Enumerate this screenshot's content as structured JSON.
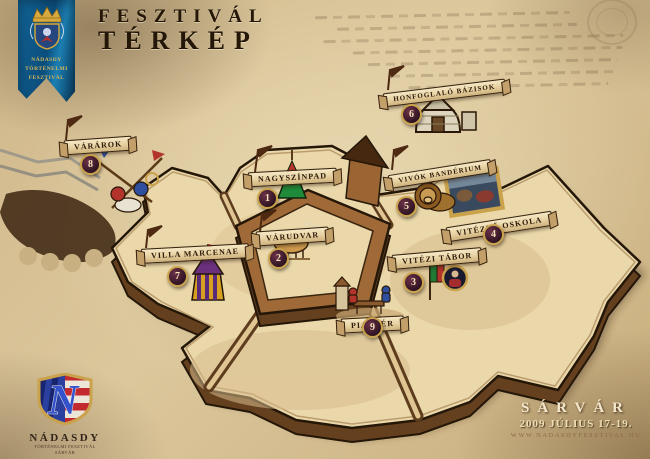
{
  "title": {
    "line1": "FESZTIVÁL",
    "line2": "TÉRKÉP"
  },
  "flag": {
    "line1": "NÁDASDY",
    "line2": "TÖRTÉNELMI",
    "line3": "FESZTIVÁL"
  },
  "locations": [
    {
      "num": "1",
      "label": "NAGYSZÍNPAD",
      "icon": "stage-tent"
    },
    {
      "num": "2",
      "label": "VÁRUDVAR",
      "icon": "ox"
    },
    {
      "num": "3",
      "label": "VITÉZI TÁBOR",
      "icon": "flag-and-portrait"
    },
    {
      "num": "4",
      "label": "VITÉZLŐ OSKOLA",
      "icon": "battle-painting"
    },
    {
      "num": "5",
      "label": "VIVÓK BANDÉRIUM",
      "icon": "lion"
    },
    {
      "num": "6",
      "label": "HONFOGLALÓ BÁZISOK",
      "icon": "yurt"
    },
    {
      "num": "7",
      "label": "VILLA MARCENAE",
      "icon": "striped-tent"
    },
    {
      "num": "8",
      "label": "VÁRÁROK",
      "icon": "battle-scene"
    },
    {
      "num": "9",
      "label": "PIACTÉR",
      "icon": "market-scene"
    }
  ],
  "footer": {
    "city": "SÁRVÁR",
    "date": "2009 JÚLIUS 17-19.",
    "url": "WWW.NADASDYFESZTIVAL.HU"
  },
  "logo": {
    "monogram": "N",
    "name": "NÁDASDY",
    "sub1": "TÖRTÉNELMI FESZTIVÁL",
    "sub2": "SÁRVÁR"
  },
  "colors": {
    "parchment": "#d3bc90",
    "ink": "#241708",
    "wall_cream": "#ead8aa",
    "wall_brown": "#6b4524",
    "accent_gold": "#c9a24b",
    "flag_blue": "#0d5a8c",
    "badge_maroon": "#3a1a28"
  }
}
